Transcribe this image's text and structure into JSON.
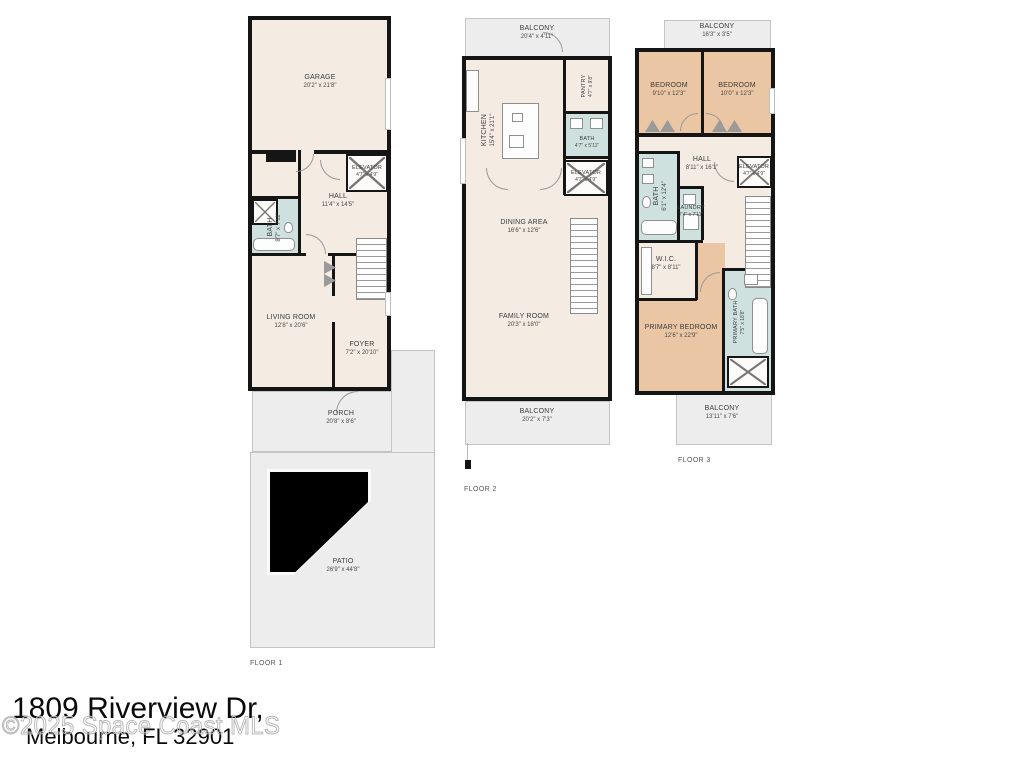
{
  "address": {
    "line1": "1809 Riverview Dr,",
    "line2": "Melbourne, FL 32901"
  },
  "watermark": "©2025 Space Coast MLS",
  "floors": [
    {
      "label": "FLOOR 1",
      "rooms": {
        "garage": {
          "name": "GARAGE",
          "dims": "20'2\" x 21'8\""
        },
        "elevator": {
          "name": "ELEVATOR",
          "dims": "4'7\" x 4'9\""
        },
        "hall": {
          "name": "HALL",
          "dims": "11'4\" x 14'5\""
        },
        "bath": {
          "name": "BATH",
          "dims": "8'7\" x 7'11\""
        },
        "living_room": {
          "name": "LIVING ROOM",
          "dims": "12'8\" x 20'6\""
        },
        "foyer": {
          "name": "FOYER",
          "dims": "7'2\" x 20'10\""
        },
        "porch": {
          "name": "PORCH",
          "dims": "20'8\" x 8'6\""
        },
        "patio": {
          "name": "PATIO",
          "dims": "26'9\" x 44'8\""
        }
      }
    },
    {
      "label": "FLOOR 2",
      "rooms": {
        "balcony_top": {
          "name": "BALCONY",
          "dims": "20'4\" x 4'11\""
        },
        "kitchen": {
          "name": "KITCHEN",
          "dims": "15'4\" x 21'1\""
        },
        "pantry": {
          "name": "PANTRY",
          "dims": "4'7\" x 9'8\""
        },
        "bath": {
          "name": "BATH",
          "dims": "4'7\" x 5'11\""
        },
        "elevator": {
          "name": "ELEVATOR",
          "dims": "4'7\" x 4'9\""
        },
        "dining_area": {
          "name": "DINING AREA",
          "dims": "16'6\" x 12'6\""
        },
        "family_room": {
          "name": "FAMILY ROOM",
          "dims": "20'3\" x 18'0\""
        },
        "balcony_bottom": {
          "name": "BALCONY",
          "dims": "20'2\" x 7'3\""
        }
      }
    },
    {
      "label": "FLOOR 3",
      "rooms": {
        "balcony_top": {
          "name": "BALCONY",
          "dims": "16'3\" x 3'5\""
        },
        "bedroom_left": {
          "name": "BEDROOM",
          "dims": "9'10\" x 12'3\""
        },
        "bedroom_right": {
          "name": "BEDROOM",
          "dims": "10'0\" x 12'3\""
        },
        "hall": {
          "name": "HALL",
          "dims": "8'11\" x 16'1\""
        },
        "elevator": {
          "name": "ELEVATOR",
          "dims": "4'7\" x 4'9\""
        },
        "bath": {
          "name": "BATH",
          "dims": "6'1\" x 12'4\""
        },
        "laundry": {
          "name": "LAUNDRY",
          "dims": "7'4\" x 7'11\""
        },
        "wic": {
          "name": "W.I.C.",
          "dims": "8'7\" x 8'11\""
        },
        "primary_bedroom": {
          "name": "PRIMARY BEDROOM",
          "dims": "12'6\" x 22'9\""
        },
        "primary_bath": {
          "name": "PRIMARY BATH",
          "dims": "7'5\" x 18'8\""
        },
        "balcony_bottom": {
          "name": "BALCONY",
          "dims": "13'11\" x 7'6\""
        }
      }
    }
  ],
  "colors": {
    "room": "#f4ebe2",
    "bath": "#cfe1df",
    "bedroom": "#eac6a4",
    "outdoor": "#ededed",
    "wall": "#151515"
  }
}
